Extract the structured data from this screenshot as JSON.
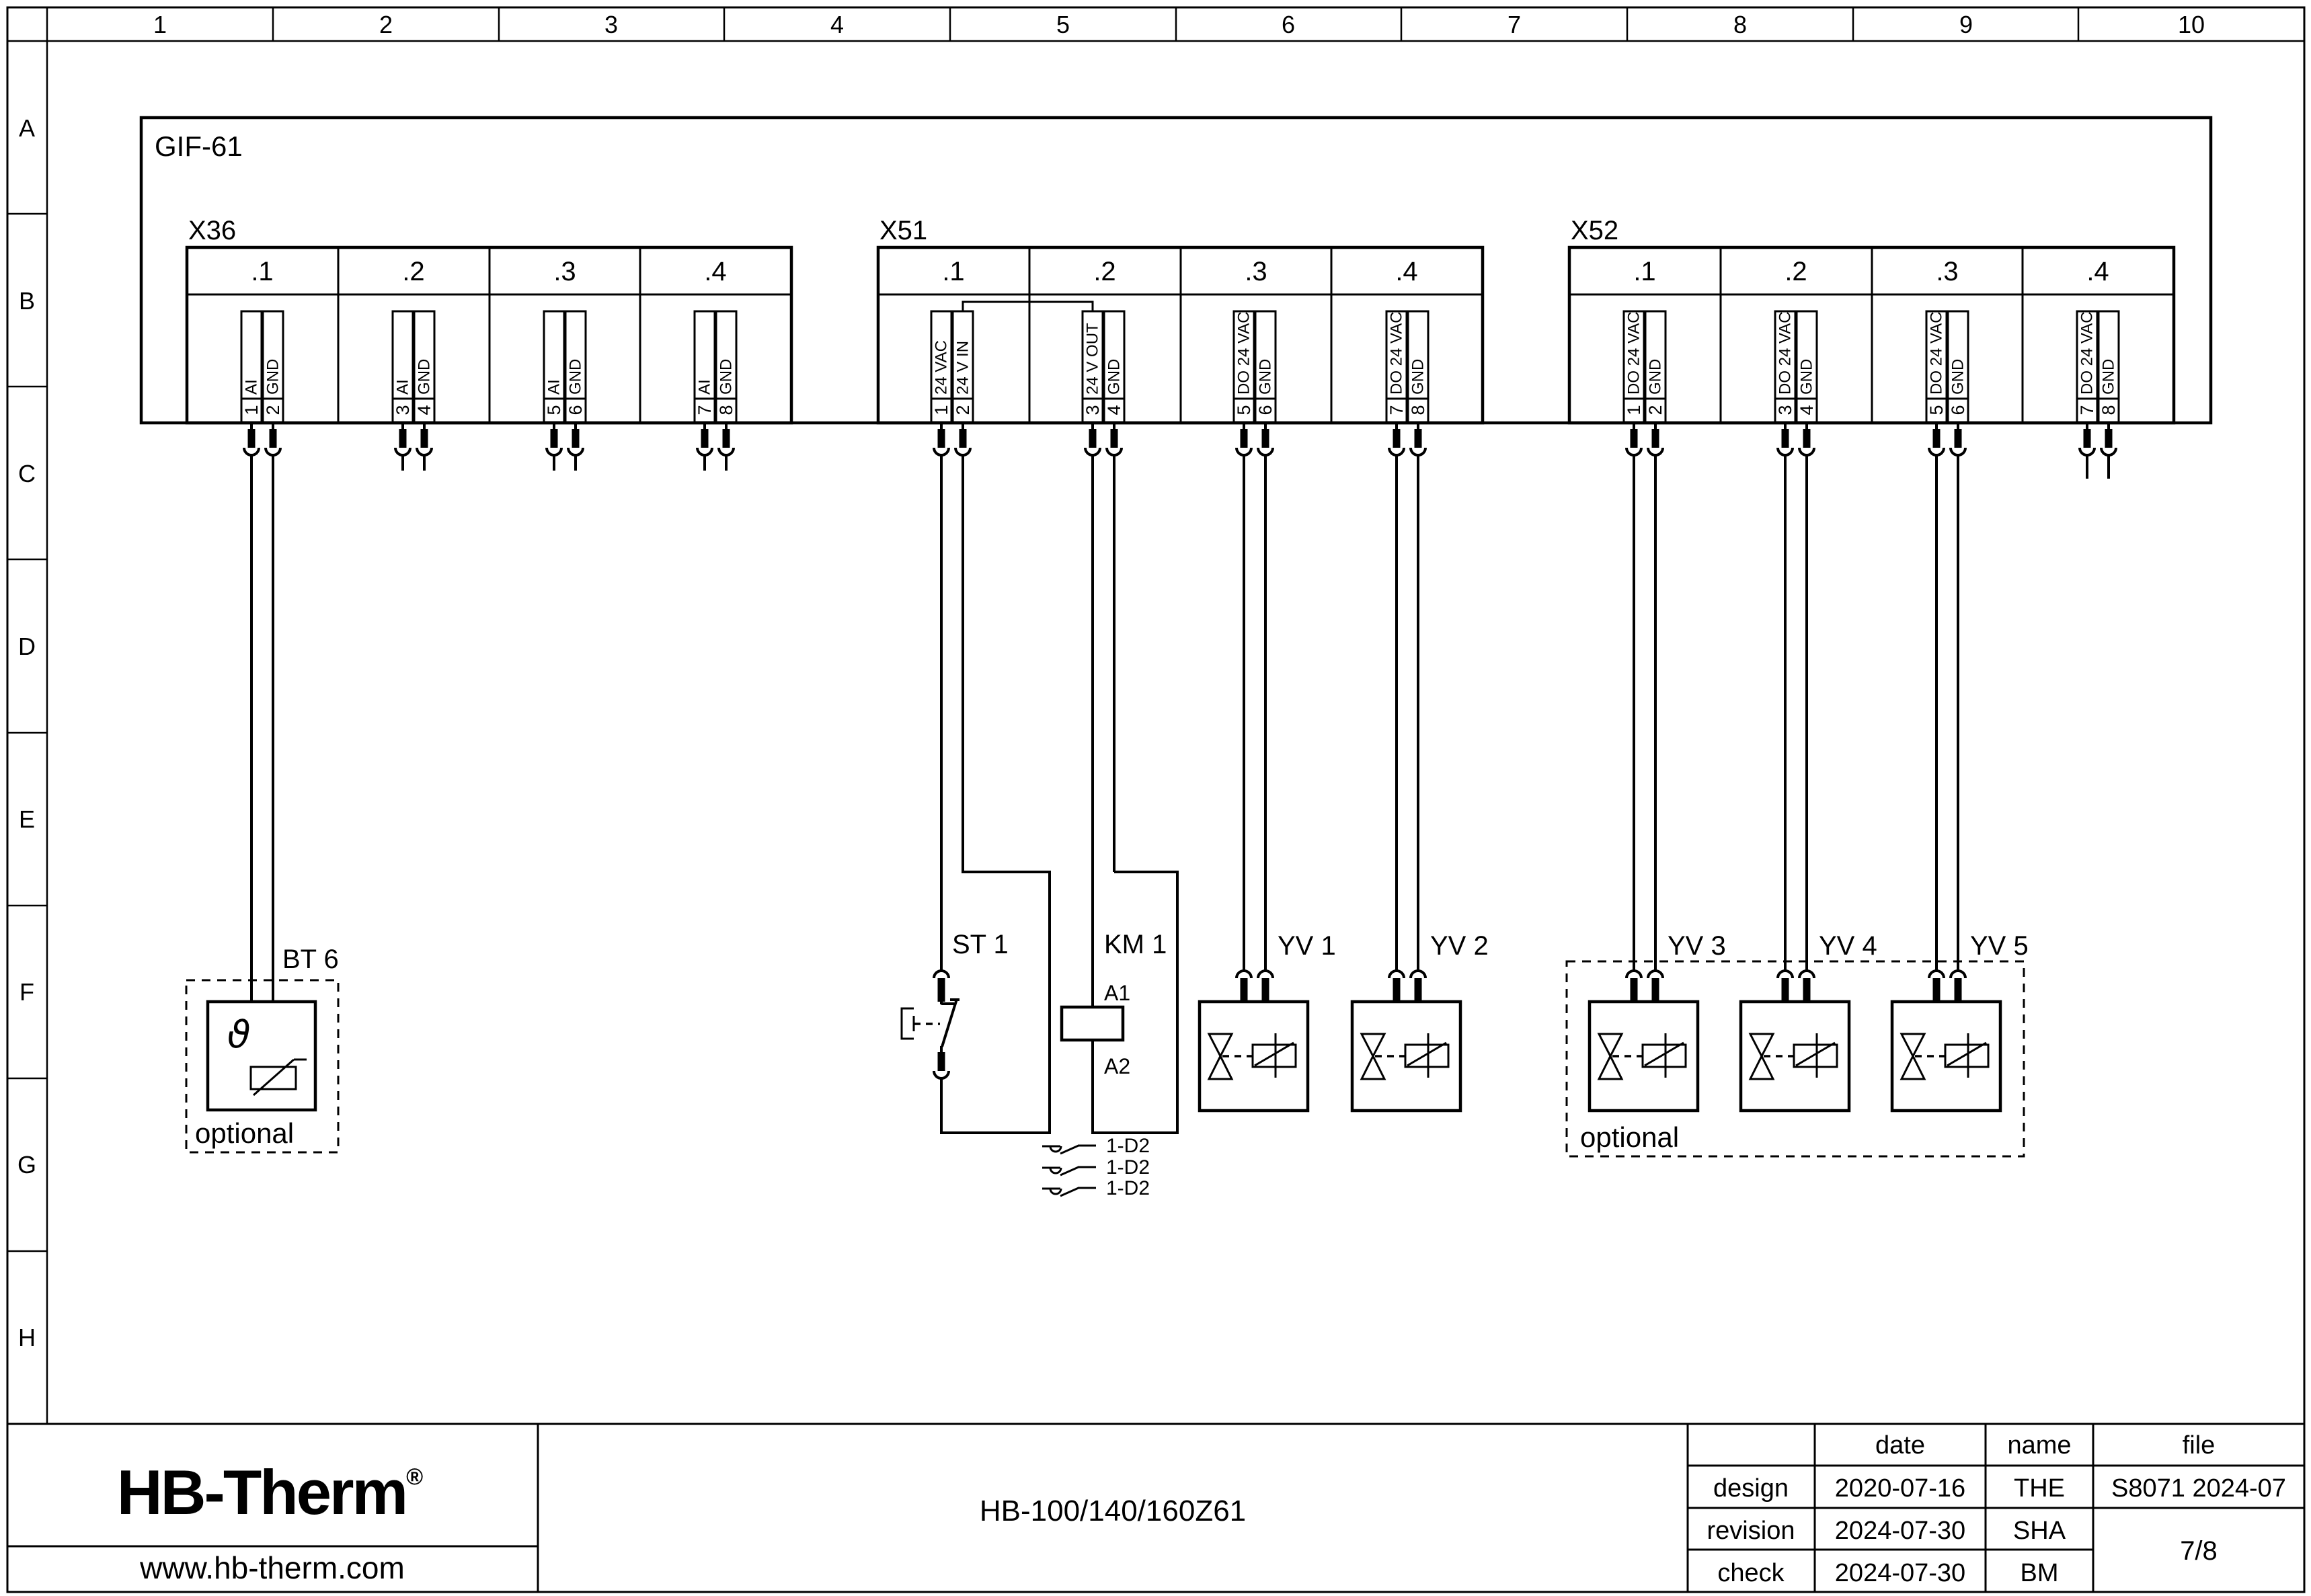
{
  "grid": {
    "columns": [
      "1",
      "2",
      "3",
      "4",
      "5",
      "6",
      "7",
      "8",
      "9",
      "10"
    ],
    "rows": [
      "A",
      "B",
      "C",
      "D",
      "E",
      "F",
      "G",
      "H"
    ]
  },
  "unit": {
    "label": "GIF-61"
  },
  "blocks": [
    {
      "name": "X36",
      "groups": [
        ".1",
        ".2",
        ".3",
        ".4"
      ],
      "pins": [
        {
          "num": "1",
          "label": "AI"
        },
        {
          "num": "2",
          "label": "GND"
        },
        {
          "num": "3",
          "label": "AI"
        },
        {
          "num": "4",
          "label": "GND"
        },
        {
          "num": "5",
          "label": "AI"
        },
        {
          "num": "6",
          "label": "GND"
        },
        {
          "num": "7",
          "label": "AI"
        },
        {
          "num": "8",
          "label": "GND"
        }
      ]
    },
    {
      "name": "X51",
      "groups": [
        ".1",
        ".2",
        ".3",
        ".4"
      ],
      "pins": [
        {
          "num": "1",
          "label": "24 VAC"
        },
        {
          "num": "2",
          "label": "24 V IN"
        },
        {
          "num": "3",
          "label": "24 V OUT"
        },
        {
          "num": "4",
          "label": "GND"
        },
        {
          "num": "5",
          "label": "DO 24 VAC"
        },
        {
          "num": "6",
          "label": "GND"
        },
        {
          "num": "7",
          "label": "DO 24 VAC"
        },
        {
          "num": "8",
          "label": "GND"
        }
      ]
    },
    {
      "name": "X52",
      "groups": [
        ".1",
        ".2",
        ".3",
        ".4"
      ],
      "pins": [
        {
          "num": "1",
          "label": "DO 24 VAC"
        },
        {
          "num": "2",
          "label": "GND"
        },
        {
          "num": "3",
          "label": "DO 24 VAC"
        },
        {
          "num": "4",
          "label": "GND"
        },
        {
          "num": "5",
          "label": "DO 24 VAC"
        },
        {
          "num": "6",
          "label": "GND"
        },
        {
          "num": "7",
          "label": "DO 24 VAC"
        },
        {
          "num": "8",
          "label": "GND"
        }
      ]
    }
  ],
  "components": {
    "bt6": {
      "label": "BT 6",
      "symbol": "ϑ",
      "optional": "optional"
    },
    "st1": {
      "label": "ST 1"
    },
    "km1": {
      "label": "KM 1",
      "a1": "A1",
      "a2": "A2"
    },
    "contacts": [
      "1-D2",
      "1-D2",
      "1-D2"
    ],
    "valves": [
      {
        "label": "YV 1"
      },
      {
        "label": "YV 2"
      },
      {
        "label": "YV 3"
      },
      {
        "label": "YV 4"
      },
      {
        "label": "YV 5"
      }
    ],
    "optional_group": "optional"
  },
  "titleblock": {
    "logo": "HB-Therm",
    "logo_reg": "®",
    "logo_color": "#1e2b4a",
    "website": "www.hb-therm.com",
    "model": "HB-100/140/160Z61",
    "table": {
      "headers": {
        "date": "date",
        "name": "name",
        "file": "file"
      },
      "rows": [
        {
          "label": "design",
          "date": "2020-07-16",
          "name": "THE"
        },
        {
          "label": "revision",
          "date": "2024-07-30",
          "name": "SHA"
        },
        {
          "label": "check",
          "date": "2024-07-30",
          "name": "BM"
        }
      ],
      "file_value": "S8071 2024-07",
      "page": "7/8"
    }
  }
}
